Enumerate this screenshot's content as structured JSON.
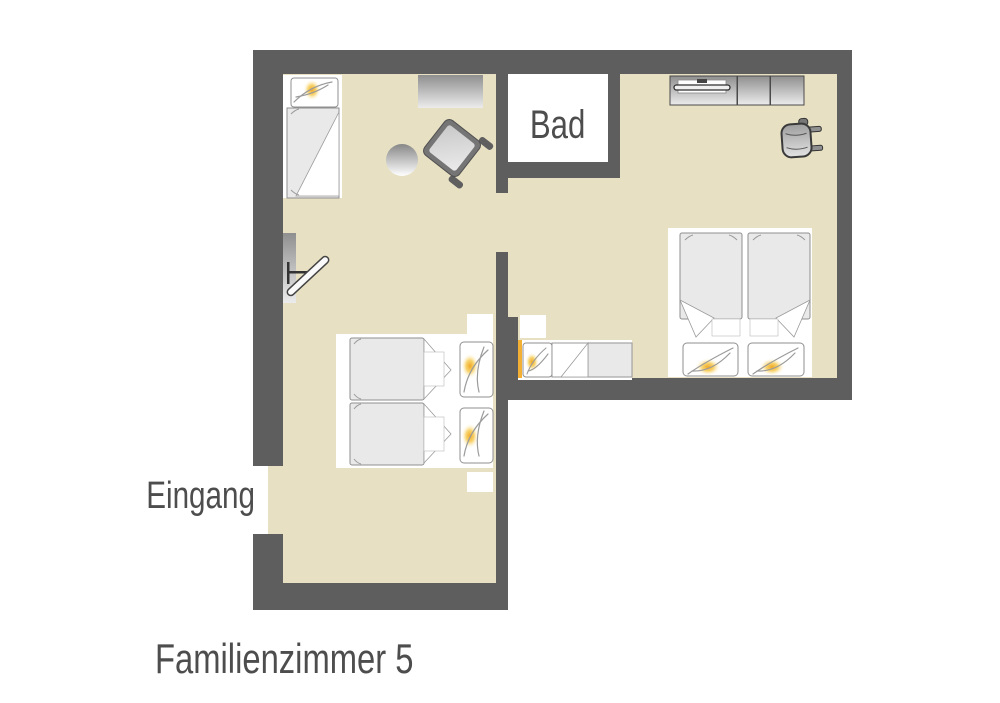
{
  "title": "Familienzimmer 5",
  "labels": {
    "bathroom": "Bad",
    "entrance": "Eingang"
  },
  "colors": {
    "wall": "#5e5e5e",
    "floor": "#e7e0c3",
    "background": "#ffffff",
    "text": "#4d4d4d",
    "duvet": "#e9e9e9",
    "furniture-outline": "#8f8f8f",
    "pillow-accent": "#f2b135",
    "backdrop": "#ffffff"
  },
  "rooms": [
    {
      "name": "bedroom-left",
      "label": ""
    },
    {
      "name": "bedroom-right",
      "label": ""
    },
    {
      "name": "bathroom",
      "label": "Bad"
    }
  ],
  "furniture": [
    {
      "room": "bedroom-left",
      "items": [
        "single-bed",
        "sideboard-small",
        "round-table",
        "armchair",
        "wall-tv",
        "double-bed",
        "nightstand",
        "nightstand"
      ]
    },
    {
      "room": "bedroom-right",
      "items": [
        "tv-sideboard",
        "armchair",
        "double-bed",
        "single-bed-small",
        "nightstand"
      ]
    }
  ]
}
